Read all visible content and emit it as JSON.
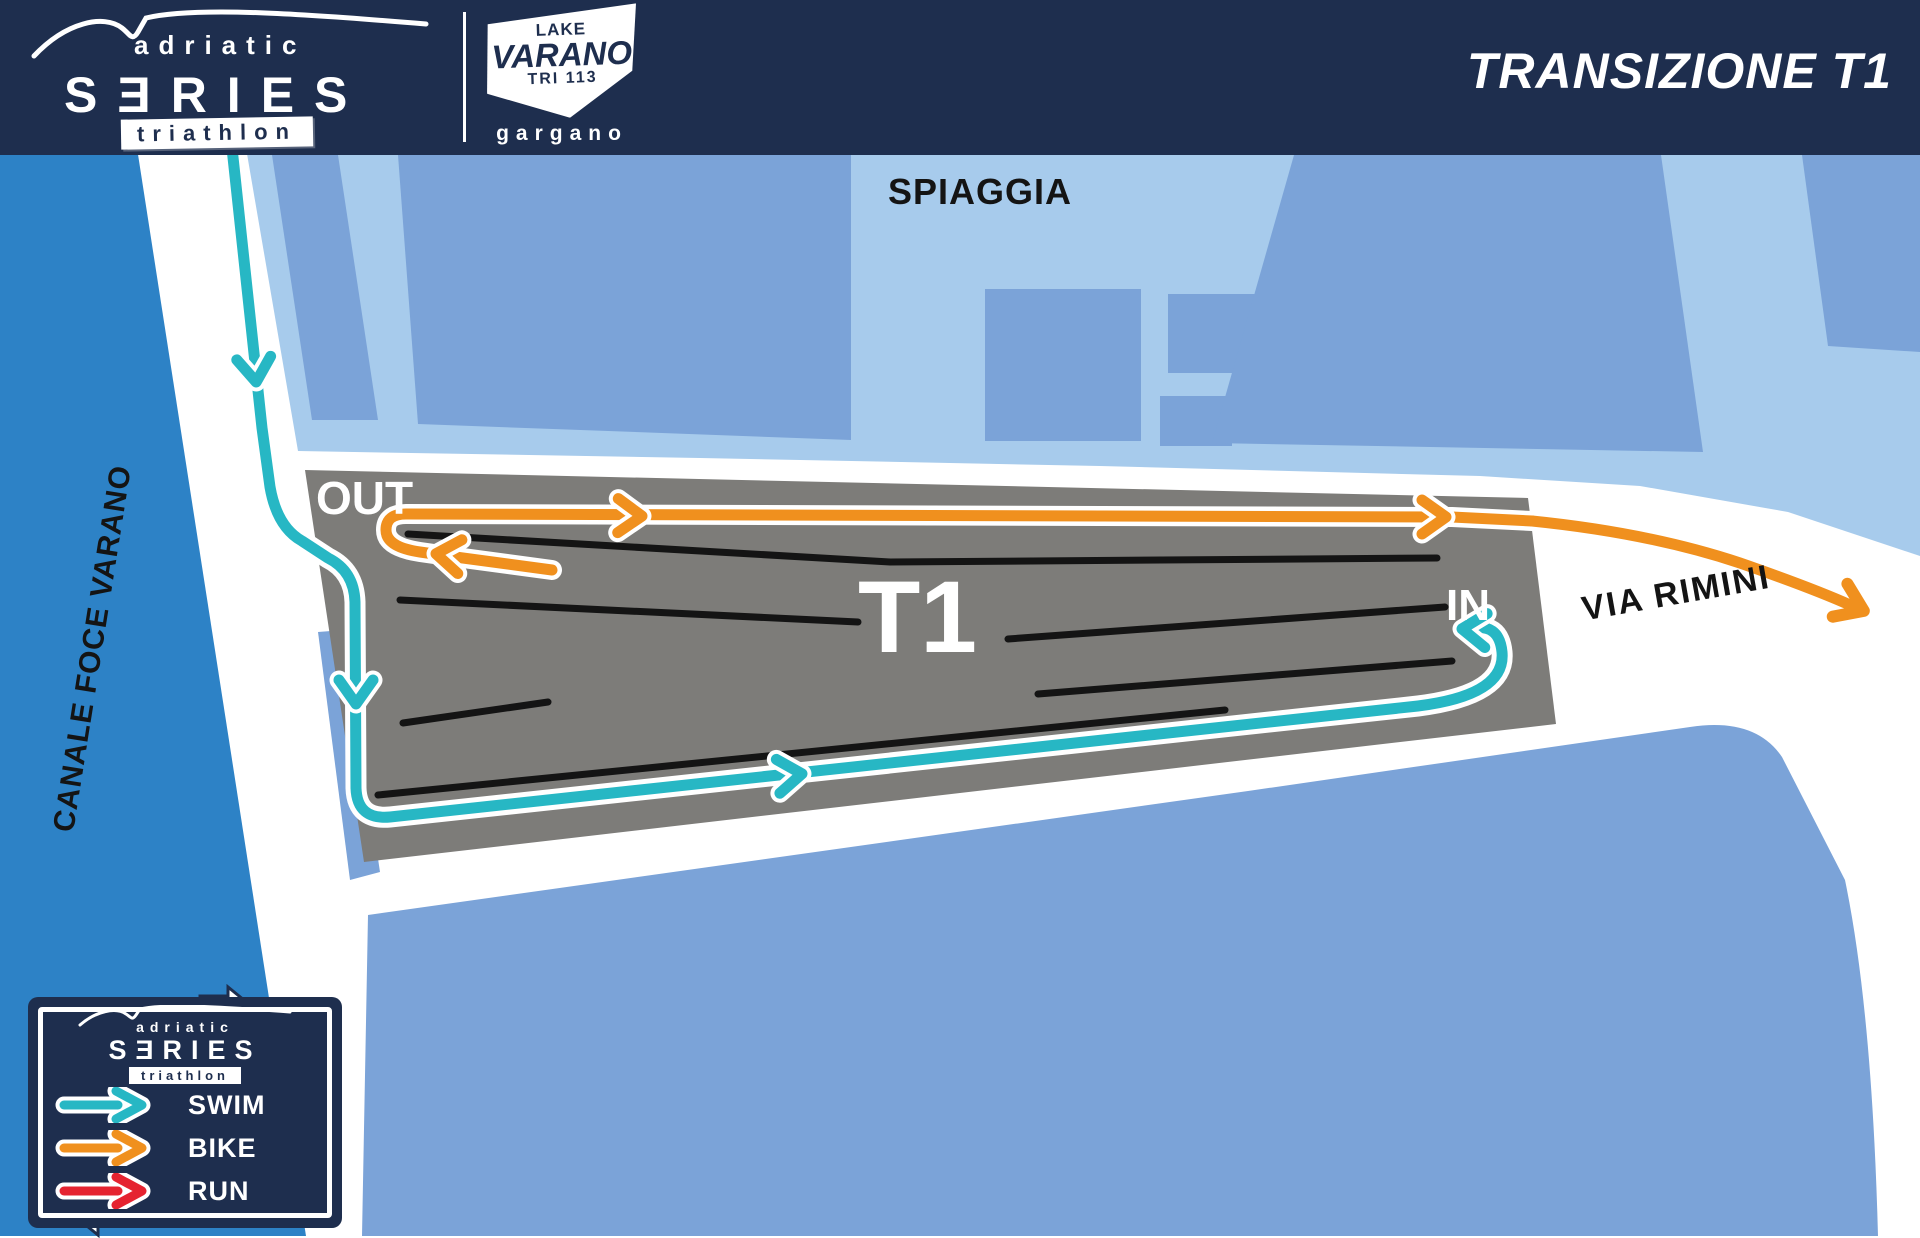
{
  "header": {
    "brand": {
      "top": "adriatic",
      "main": "SƎRIES",
      "sub": "triathlon"
    },
    "badge": {
      "line1": "LAKE",
      "line2": "VARANO",
      "line3": "TRI 113",
      "region": "gargano"
    },
    "title": "TRANSIZIONE T1"
  },
  "map": {
    "labels": {
      "beach": "SPIAGGIA",
      "canal": "CANALE FOCE VARANO",
      "road": "VIA RIMINI",
      "zone": "T1",
      "out": "OUT",
      "in": "IN"
    }
  },
  "legend": {
    "brand": {
      "top": "adriatic",
      "main": "SƎRIES",
      "sub": "triathlon"
    },
    "items": [
      {
        "label": "SWIM"
      },
      {
        "label": "BIKE"
      },
      {
        "label": "RUN"
      }
    ]
  },
  "colors": {
    "header_navy": "#1e2e4e",
    "canal_blue": "#2d82c6",
    "block_blue": "#7ba3d8",
    "beach_blue": "#a7cbec",
    "transition_gray": "#7d7c79",
    "swim": "#27b7c4",
    "bike": "#f0901e",
    "run": "#e52330",
    "rack_black": "#141414",
    "road_white": "#ffffff"
  }
}
